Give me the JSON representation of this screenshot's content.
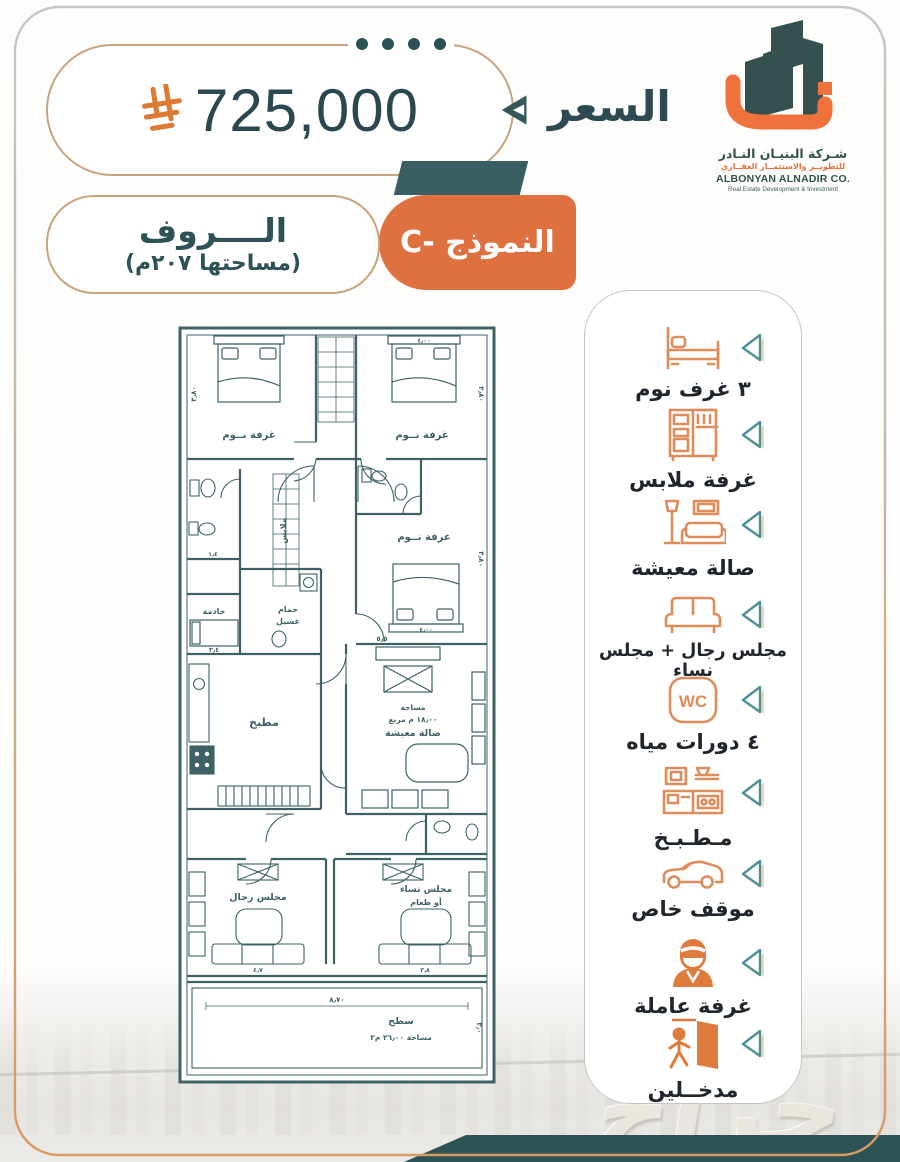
{
  "page": {
    "watermark": "حراج"
  },
  "price": {
    "label": "السعر",
    "value": "725,000",
    "currency_icon": "saudi-riyal-symbol"
  },
  "unit": {
    "name": "الــــروف",
    "area_note": "(مساحتها ٢٠٧م)",
    "model": "النموذج -C"
  },
  "logo": {
    "company_ar": "شـركة البنيـان النـادر",
    "tagline_ar": "للتطويــر والاستثمــار العقــاري",
    "company_en": "ALBONYAN ALNADIR CO.",
    "tagline_en": "Real Estate Development & Investment"
  },
  "features": {
    "wc_text": "WC",
    "items": [
      {
        "icon": "bed-icon",
        "label": "٣ غرف نوم"
      },
      {
        "icon": "wardrobe-icon",
        "label": "غرفة ملابس"
      },
      {
        "icon": "living-room-icon",
        "label": "صالة معيشة"
      },
      {
        "icon": "sofa-icon",
        "label": "مجلس رجال + مجلس نساء"
      },
      {
        "icon": "wc-icon",
        "label": "٤ دورات مياه"
      },
      {
        "icon": "kitchen-icon",
        "label": "مـطـبـخ"
      },
      {
        "icon": "car-icon",
        "label": "موقف خاص"
      },
      {
        "icon": "maid-icon",
        "label": "غرفة عاملة"
      },
      {
        "icon": "door-entrance-icon",
        "label": "مدخــلين"
      }
    ]
  },
  "floorplan": {
    "rooms": {
      "bedroom1": "غرفة نــوم",
      "bedroom2": "غرفة نــوم",
      "bedroom3": "غرفة نــوم",
      "closet": "ملابس",
      "laundry_l1": "حمام",
      "laundry_l2": "غسيل",
      "maid": "خادمة",
      "kitchen": "مطبخ",
      "living_l1": "مساحة",
      "living_l2": "١٨٫٠٠ م مربع",
      "living_l3": "صالة معيشة",
      "majlis_men": "مجلس رجال",
      "majlis_women_l1": "مجلس نساء",
      "majlis_women_l2": "أو طعام",
      "terrace": "سطح",
      "terrace_area": "مساحة ٢٦٫٠٠ م٢"
    },
    "dims": {
      "bed1_side": "٣٫٨٠",
      "bed2_side": "٣٫٨٠",
      "bed3_side": "٣٫٨٠",
      "bed2_w": "٤٫٠٠",
      "bed3_w": "٤٫٠٠",
      "maid_w": "٣٫٤",
      "bath_w": "١٫٤",
      "living_w": "٥٫٥",
      "men_w": "٤٫٧",
      "women_w": "٣٫٨",
      "terrace_w": "٨٫٧٠",
      "terrace_h": "٣٫٠"
    }
  }
}
